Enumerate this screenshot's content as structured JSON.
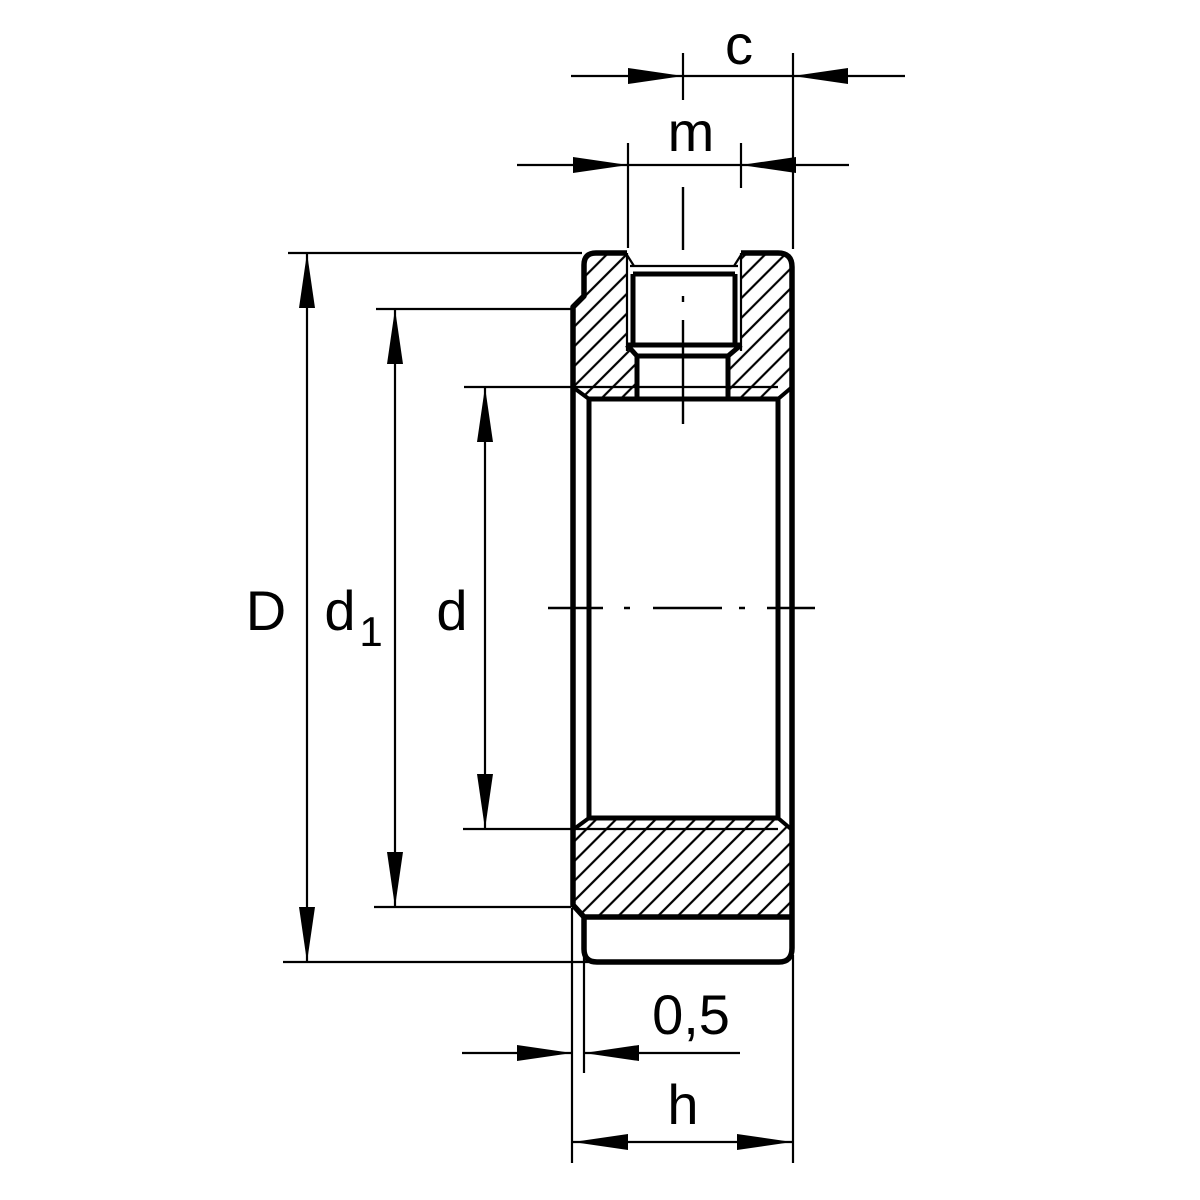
{
  "drawing": {
    "description": "Cross-section technical drawing of a locknut with set screw hole",
    "colors": {
      "line": "#000000",
      "background": "#ffffff"
    },
    "labels": {
      "c": "c",
      "m": "m",
      "D": "D",
      "d1_base": "d",
      "d1_sub": "1",
      "d": "d",
      "recess": "0,5",
      "h": "h"
    }
  }
}
